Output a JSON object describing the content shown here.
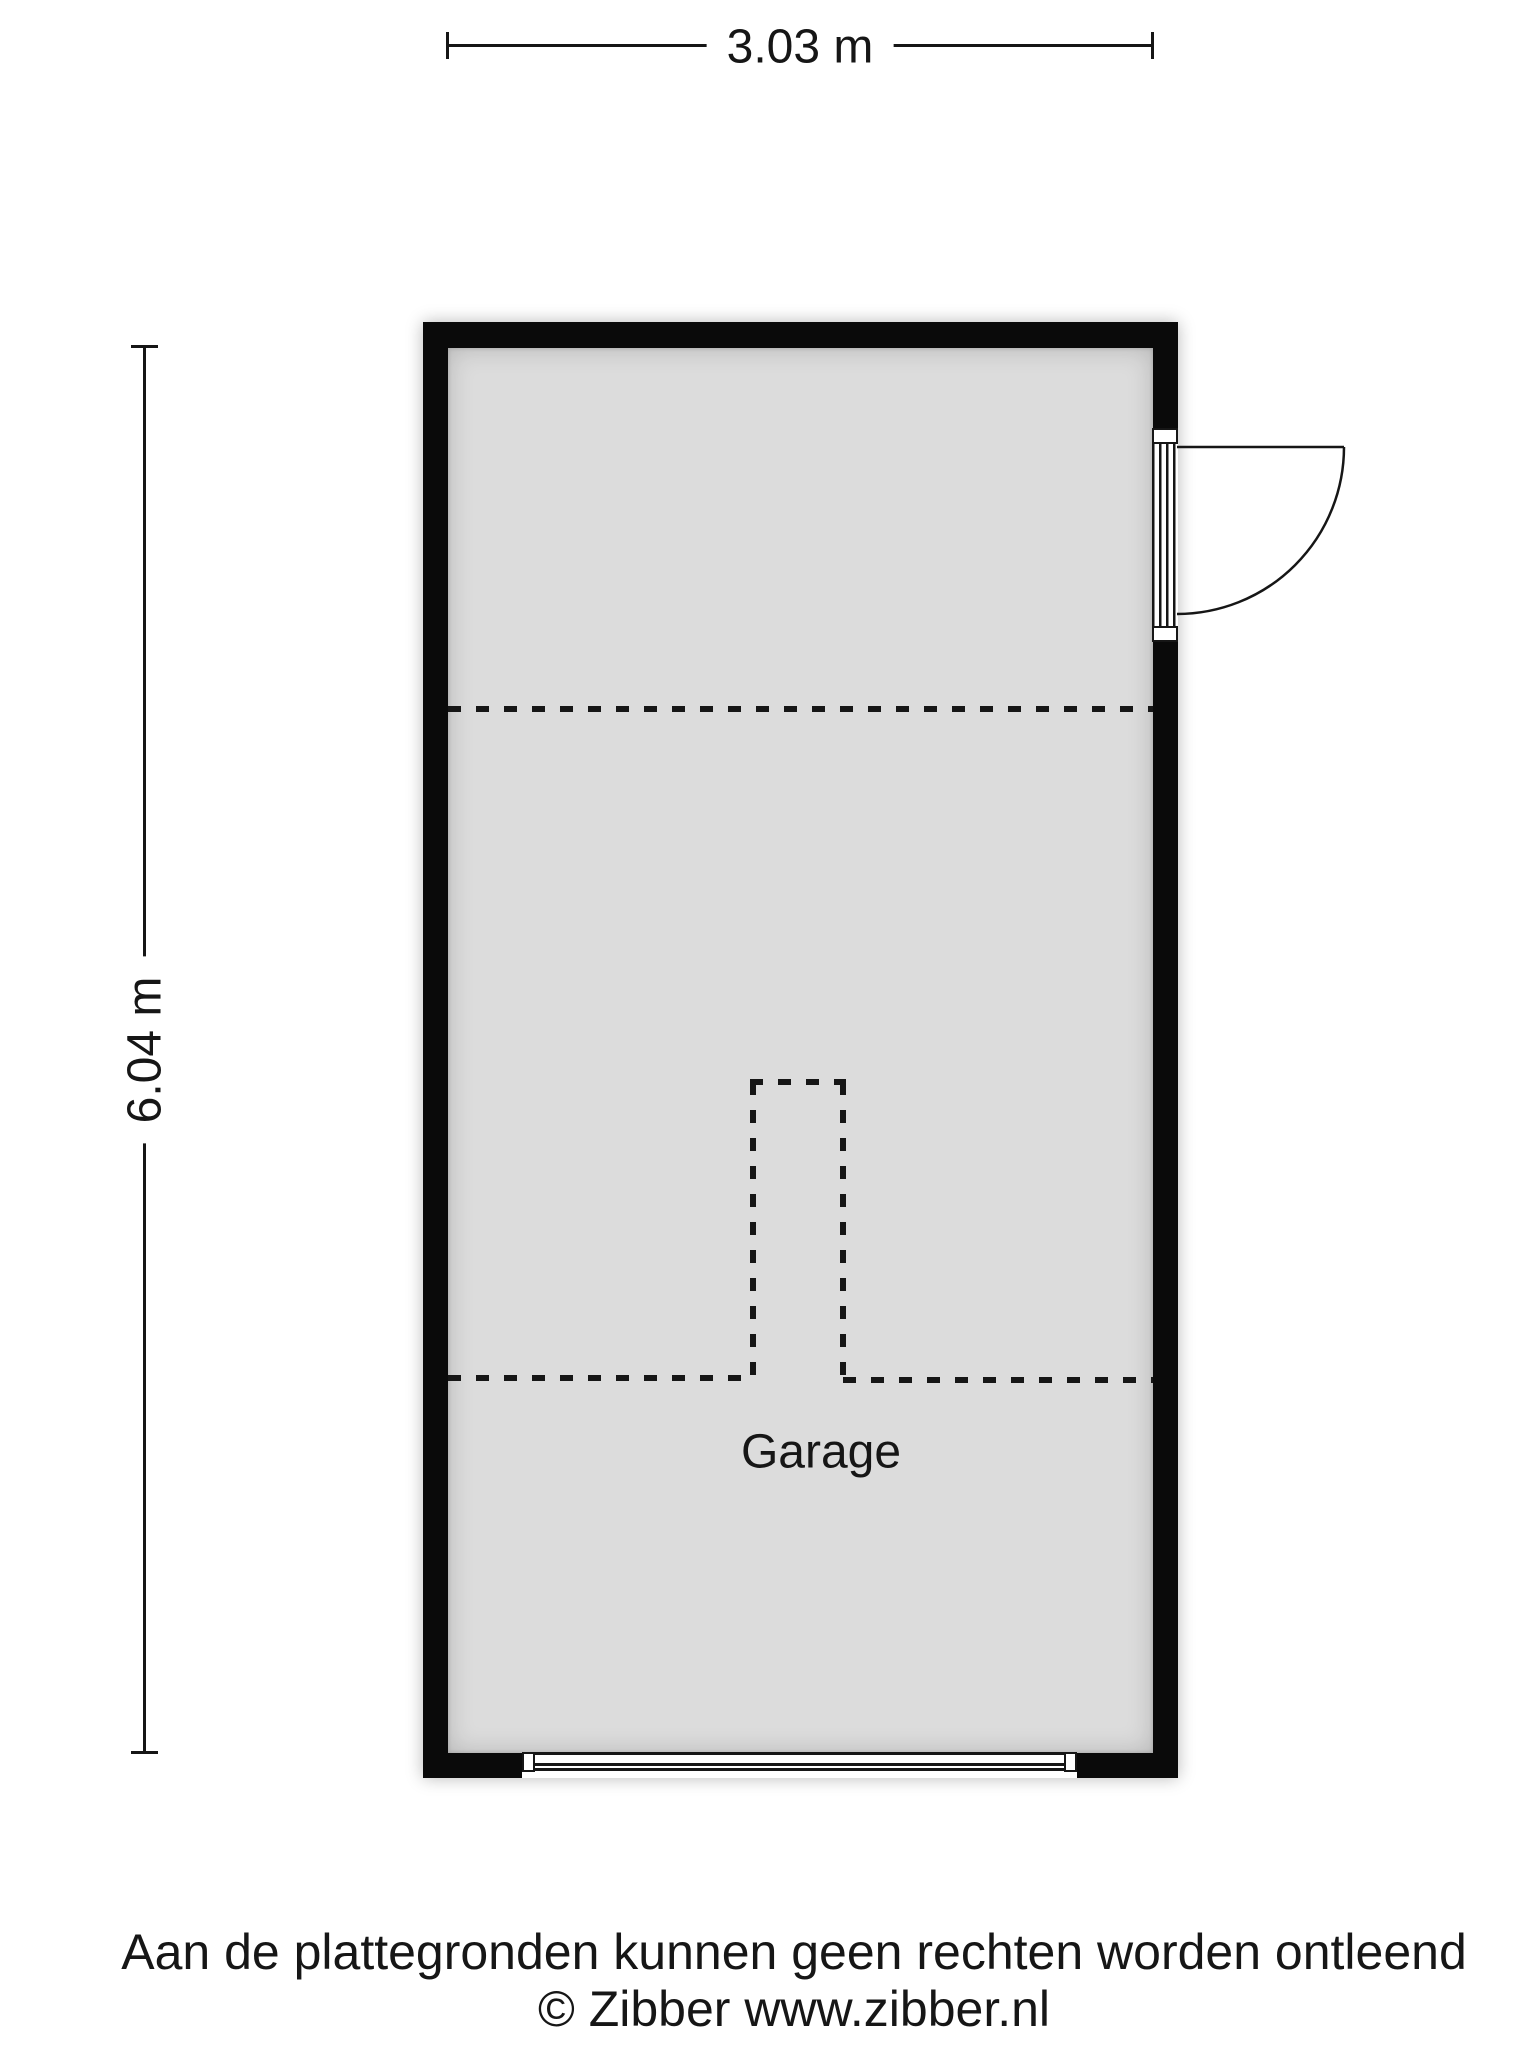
{
  "dimensions": {
    "width_label": "3.03 m",
    "height_label": "6.04 m"
  },
  "room": {
    "label": "Garage"
  },
  "footer": {
    "disclaimer": "Aan de plattegronden kunnen geen rechten worden ontleend",
    "copyright": "© Zibber www.zibber.nl"
  },
  "colors": {
    "wall": "#0a0a0a",
    "floor": "#dcdcdc",
    "ink": "#161616"
  }
}
